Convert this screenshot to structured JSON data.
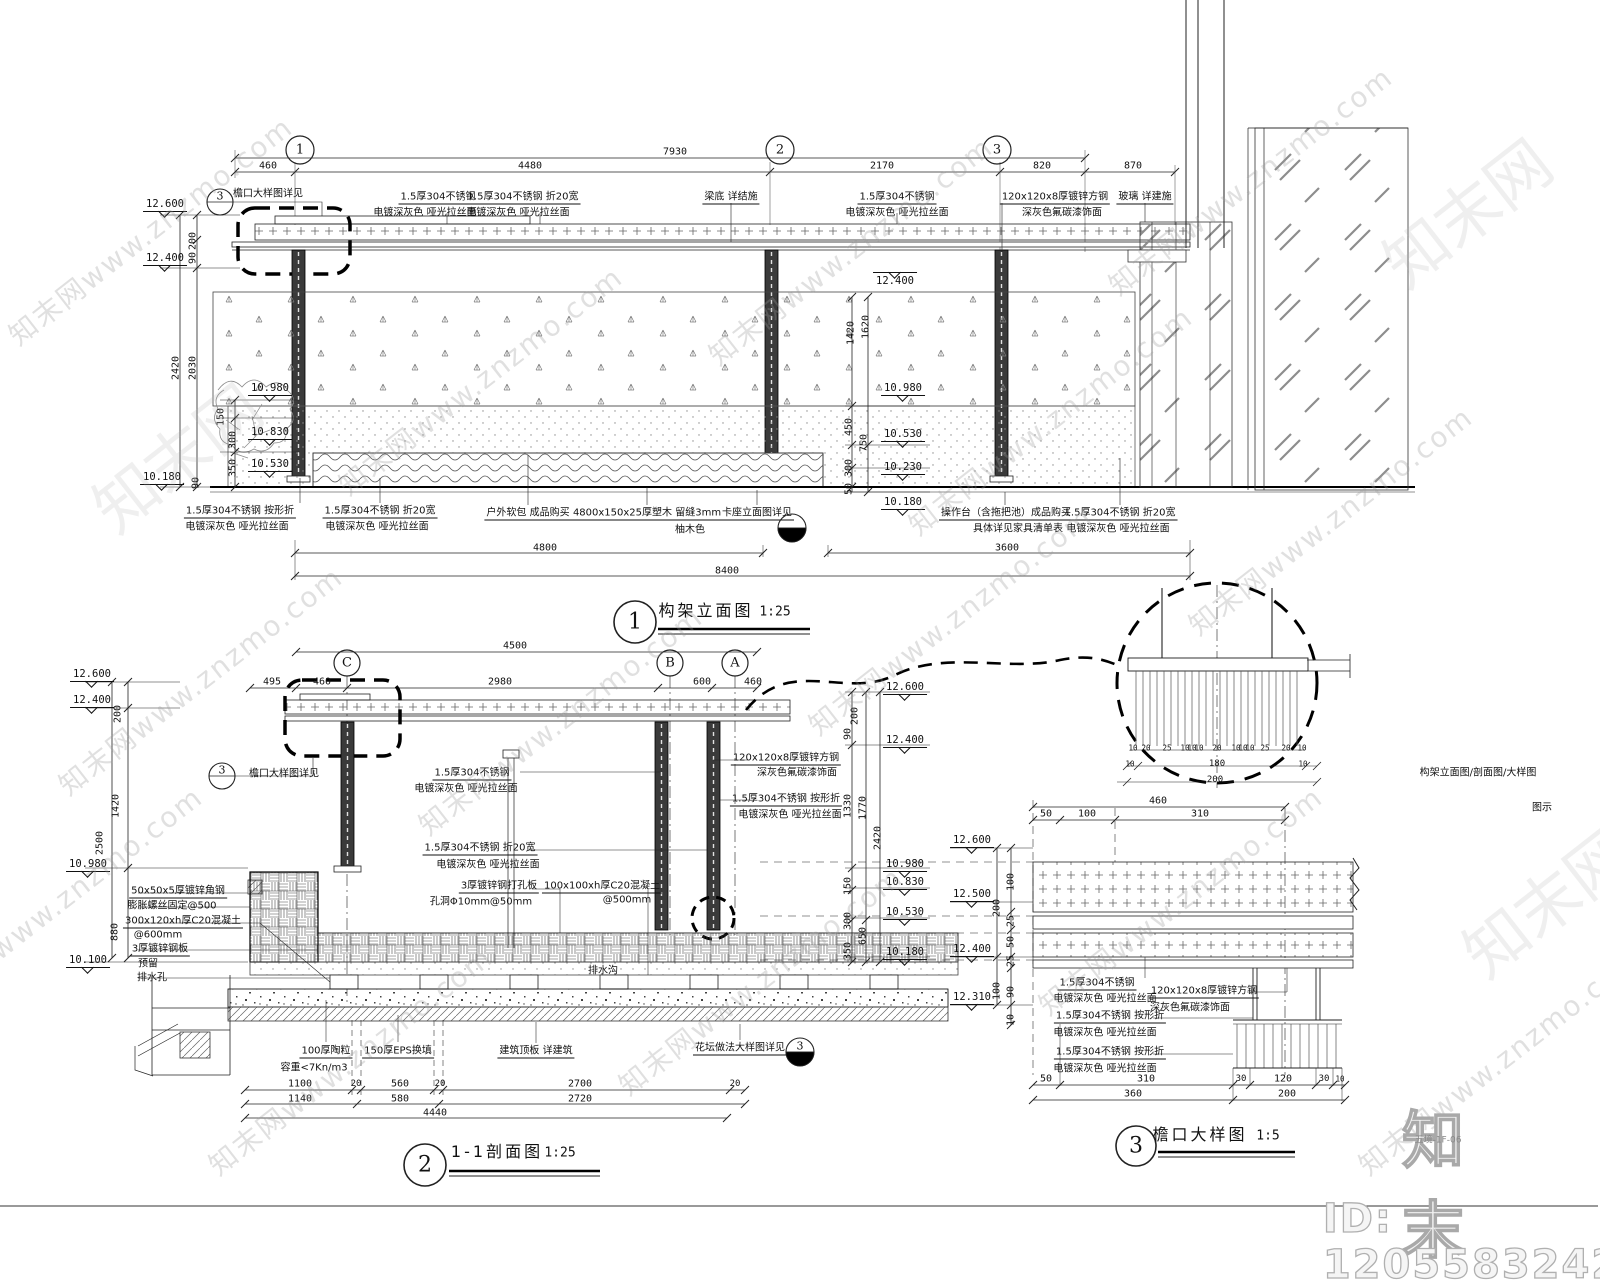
{
  "sheet": {
    "code": "五境-1F-06"
  },
  "watermark": {
    "text": "知末网www.znzmo.com",
    "glyph": "知末网",
    "logo": "知末",
    "id_text": "ID: 1205583242",
    "positions": [
      [
        150,
        230
      ],
      [
        480,
        380
      ],
      [
        850,
        250
      ],
      [
        1250,
        180
      ],
      [
        200,
        680
      ],
      [
        560,
        720
      ],
      [
        950,
        620
      ],
      [
        1330,
        520
      ],
      [
        350,
        1060
      ],
      [
        760,
        980
      ],
      [
        1180,
        900
      ],
      [
        1500,
        1060
      ],
      [
        60,
        900
      ],
      [
        1050,
        420
      ]
    ],
    "glyph_positions": [
      [
        1465,
        210
      ],
      [
        175,
        455
      ],
      [
        1545,
        900
      ]
    ]
  },
  "views": [
    {
      "num": "1",
      "name": "构架立面图",
      "scale": "1:25"
    },
    {
      "num": "2",
      "name": "1-1剖面图",
      "scale": "1:25"
    },
    {
      "num": "3",
      "name": "檐口大样图",
      "scale": "1:5"
    }
  ],
  "side_note": "构架立面图/剖面图/大样图",
  "side_note2": "图示",
  "labels": [
    {
      "t": "7930",
      "x": 675,
      "y": 152,
      "c": "dim"
    },
    {
      "t": "460",
      "x": 268,
      "y": 166,
      "c": "dim"
    },
    {
      "t": "4480",
      "x": 530,
      "y": 166,
      "c": "dim"
    },
    {
      "t": "2170",
      "x": 882,
      "y": 166,
      "c": "dim"
    },
    {
      "t": "820",
      "x": 1042,
      "y": 166,
      "c": "dim"
    },
    {
      "t": "870",
      "x": 1133,
      "y": 166,
      "c": "dim"
    },
    {
      "t": "1",
      "x": 300,
      "y": 150,
      "c": "bub"
    },
    {
      "t": "2",
      "x": 780,
      "y": 150,
      "c": "bub"
    },
    {
      "t": "3",
      "x": 997,
      "y": 150,
      "c": "bub"
    },
    {
      "t": "3",
      "x": 220,
      "y": 196,
      "c": "bubs"
    },
    {
      "t": "檐口大样图详见",
      "x": 268,
      "y": 192,
      "c": "ann"
    },
    {
      "t": "1.5厚304不锈钢",
      "x": 438,
      "y": 196,
      "c": "annu"
    },
    {
      "t": "电镀深灰色 哑光拉丝面",
      "x": 425,
      "y": 211,
      "c": "ann"
    },
    {
      "t": "1.5厚304不锈钢 折20宽",
      "x": 523,
      "y": 196,
      "c": "annu"
    },
    {
      "t": "电镀深灰色 哑光拉丝面",
      "x": 518,
      "y": 211,
      "c": "ann"
    },
    {
      "t": "梁底 详结施",
      "x": 731,
      "y": 196,
      "c": "annu"
    },
    {
      "t": "1.5厚304不锈钢",
      "x": 897,
      "y": 196,
      "c": "annu"
    },
    {
      "t": "电镀深灰色 哑光拉丝面",
      "x": 897,
      "y": 211,
      "c": "ann"
    },
    {
      "t": "120x120x8厚镀锌方钢",
      "x": 1055,
      "y": 196,
      "c": "annu"
    },
    {
      "t": "深灰色氟碳漆饰面",
      "x": 1062,
      "y": 211,
      "c": "ann"
    },
    {
      "t": "玻璃 详建施",
      "x": 1145,
      "y": 196,
      "c": "annu"
    },
    {
      "t": "12.400",
      "x": 895,
      "y": 272,
      "c": "elevt"
    },
    {
      "t": "12.600",
      "x": 165,
      "y": 212,
      "c": "elev"
    },
    {
      "t": "12.400",
      "x": 165,
      "y": 266,
      "c": "elev"
    },
    {
      "t": "10.180",
      "x": 162,
      "y": 485,
      "c": "elev"
    },
    {
      "t": "200",
      "x": 193,
      "y": 241,
      "c": "dimv"
    },
    {
      "t": "90",
      "x": 193,
      "y": 258,
      "c": "dimv"
    },
    {
      "t": "2420",
      "x": 176,
      "y": 368,
      "c": "dimv"
    },
    {
      "t": "2030",
      "x": 193,
      "y": 368,
      "c": "dimv"
    },
    {
      "t": "90",
      "x": 196,
      "y": 483,
      "c": "dimv"
    },
    {
      "t": "150",
      "x": 221,
      "y": 417,
      "c": "dimv"
    },
    {
      "t": "300",
      "x": 233,
      "y": 440,
      "c": "dimv"
    },
    {
      "t": "350",
      "x": 233,
      "y": 468,
      "c": "dimv"
    },
    {
      "t": "10.980",
      "x": 270,
      "y": 396,
      "c": "elev"
    },
    {
      "t": "10.830",
      "x": 270,
      "y": 440,
      "c": "elev"
    },
    {
      "t": "10.530",
      "x": 270,
      "y": 472,
      "c": "elev"
    },
    {
      "t": "1420",
      "x": 851,
      "y": 333,
      "c": "dimv"
    },
    {
      "t": "1620",
      "x": 866,
      "y": 327,
      "c": "dimv"
    },
    {
      "t": "450",
      "x": 849,
      "y": 427,
      "c": "dimv"
    },
    {
      "t": "750",
      "x": 864,
      "y": 443,
      "c": "dimv"
    },
    {
      "t": "300",
      "x": 849,
      "y": 468,
      "c": "dimv"
    },
    {
      "t": "50",
      "x": 849,
      "y": 489,
      "c": "dimv"
    },
    {
      "t": "10.980",
      "x": 903,
      "y": 396,
      "c": "elev"
    },
    {
      "t": "10.530",
      "x": 903,
      "y": 442,
      "c": "elev"
    },
    {
      "t": "10.230",
      "x": 903,
      "y": 475,
      "c": "elev"
    },
    {
      "t": "10.180",
      "x": 903,
      "y": 510,
      "c": "elev"
    },
    {
      "t": "1.5厚304不锈钢 按形折",
      "x": 240,
      "y": 510,
      "c": "annu"
    },
    {
      "t": "电镀深灰色 哑光拉丝面",
      "x": 237,
      "y": 525,
      "c": "ann"
    },
    {
      "t": "1.5厚304不锈钢 折20宽",
      "x": 380,
      "y": 510,
      "c": "annu"
    },
    {
      "t": "电镀深灰色 哑光拉丝面",
      "x": 377,
      "y": 525,
      "c": "ann"
    },
    {
      "t": "户外软包 成品购买",
      "x": 528,
      "y": 512,
      "c": "annu"
    },
    {
      "t": "4800x150x25厚塑木 留缝3mm",
      "x": 647,
      "y": 512,
      "c": "annu"
    },
    {
      "t": "柚木色",
      "x": 690,
      "y": 528,
      "c": "ann"
    },
    {
      "t": "卡座立面图详见",
      "x": 757,
      "y": 512,
      "c": "annu"
    },
    {
      "t": "操作台（含拖把池）成品购买",
      "x": 1006,
      "y": 512,
      "c": "annu"
    },
    {
      "t": "具体详见家具清单表",
      "x": 1018,
      "y": 527,
      "c": "ann"
    },
    {
      "t": "1.5厚304不锈钢 折20宽",
      "x": 1120,
      "y": 512,
      "c": "annu"
    },
    {
      "t": "电镀深灰色 哑光拉丝面",
      "x": 1118,
      "y": 527,
      "c": "ann"
    },
    {
      "t": "4800",
      "x": 545,
      "y": 548,
      "c": "dim"
    },
    {
      "t": "3600",
      "x": 1007,
      "y": 548,
      "c": "dim"
    },
    {
      "t": "8400",
      "x": 727,
      "y": 571,
      "c": "dim"
    },
    {
      "t": "1",
      "x": 635,
      "y": 622,
      "c": "tnum"
    },
    {
      "t": "构架立面图",
      "x": 706,
      "y": 609,
      "c": "ttl"
    },
    {
      "t": "1:25",
      "x": 775,
      "y": 612,
      "c": "sc"
    },
    {
      "t": "C",
      "x": 347,
      "y": 663,
      "c": "bub"
    },
    {
      "t": "B",
      "x": 670,
      "y": 663,
      "c": "bub"
    },
    {
      "t": "A",
      "x": 735,
      "y": 663,
      "c": "bub"
    },
    {
      "t": "4500",
      "x": 515,
      "y": 646,
      "c": "dim"
    },
    {
      "t": "495",
      "x": 272,
      "y": 682,
      "c": "dim"
    },
    {
      "t": "460",
      "x": 322,
      "y": 682,
      "c": "dim"
    },
    {
      "t": "2980",
      "x": 500,
      "y": 682,
      "c": "dim"
    },
    {
      "t": "600",
      "x": 702,
      "y": 682,
      "c": "dim"
    },
    {
      "t": "460",
      "x": 753,
      "y": 682,
      "c": "dim"
    },
    {
      "t": "12.600",
      "x": 92,
      "y": 682,
      "c": "elev"
    },
    {
      "t": "12.400",
      "x": 92,
      "y": 708,
      "c": "elev"
    },
    {
      "t": "200",
      "x": 118,
      "y": 714,
      "c": "dimv"
    },
    {
      "t": "1420",
      "x": 116,
      "y": 806,
      "c": "dimv"
    },
    {
      "t": "2500",
      "x": 100,
      "y": 843,
      "c": "dimv"
    },
    {
      "t": "10.980",
      "x": 88,
      "y": 872,
      "c": "elev"
    },
    {
      "t": "880",
      "x": 115,
      "y": 932,
      "c": "dimv"
    },
    {
      "t": "10.100",
      "x": 88,
      "y": 968,
      "c": "elev"
    },
    {
      "t": "3",
      "x": 222,
      "y": 770,
      "c": "bubs"
    },
    {
      "t": "檐口大样图详见",
      "x": 284,
      "y": 772,
      "c": "ann"
    },
    {
      "t": "50x50x5厚镀锌角钢",
      "x": 178,
      "y": 890,
      "c": "annu"
    },
    {
      "t": "膨胀螺丝固定@500",
      "x": 172,
      "y": 904,
      "c": "ann"
    },
    {
      "t": "300x120xh厚C20混凝土",
      "x": 183,
      "y": 920,
      "c": "annu"
    },
    {
      "t": "@600mm",
      "x": 158,
      "y": 935,
      "c": "ann"
    },
    {
      "t": "3厚镀锌钢板",
      "x": 160,
      "y": 948,
      "c": "annu"
    },
    {
      "t": "预留",
      "x": 148,
      "y": 962,
      "c": "ann"
    },
    {
      "t": "排水孔",
      "x": 152,
      "y": 976,
      "c": "ann"
    },
    {
      "t": "1.5厚304不锈钢",
      "x": 472,
      "y": 772,
      "c": "annu"
    },
    {
      "t": "电镀深灰色 哑光拉丝面",
      "x": 466,
      "y": 787,
      "c": "ann"
    },
    {
      "t": "1.5厚304不锈钢 折20宽",
      "x": 480,
      "y": 847,
      "c": "annu"
    },
    {
      "t": "电镀深灰色 哑光拉丝面",
      "x": 488,
      "y": 863,
      "c": "ann"
    },
    {
      "t": "3厚镀锌钢打孔板",
      "x": 499,
      "y": 885,
      "c": "annu"
    },
    {
      "t": "孔洞Φ10mm@50mm",
      "x": 481,
      "y": 900,
      "c": "ann"
    },
    {
      "t": "100x100xh厚C20混凝土",
      "x": 602,
      "y": 885,
      "c": "annu"
    },
    {
      "t": "@500mm",
      "x": 627,
      "y": 900,
      "c": "ann"
    },
    {
      "t": "120x120x8厚镀锌方钢",
      "x": 786,
      "y": 757,
      "c": "annu"
    },
    {
      "t": "深灰色氟碳漆饰面",
      "x": 797,
      "y": 771,
      "c": "ann"
    },
    {
      "t": "1.5厚304不锈钢 按形折",
      "x": 786,
      "y": 798,
      "c": "annu"
    },
    {
      "t": "电镀深灰色 哑光拉丝面",
      "x": 790,
      "y": 813,
      "c": "ann"
    },
    {
      "t": "排水沟",
      "x": 603,
      "y": 969,
      "c": "ann"
    },
    {
      "t": "200",
      "x": 855,
      "y": 716,
      "c": "dimv"
    },
    {
      "t": "90",
      "x": 848,
      "y": 734,
      "c": "dimv"
    },
    {
      "t": "1330",
      "x": 848,
      "y": 806,
      "c": "dimv"
    },
    {
      "t": "1770",
      "x": 863,
      "y": 808,
      "c": "dimv"
    },
    {
      "t": "2420",
      "x": 878,
      "y": 838,
      "c": "dimv"
    },
    {
      "t": "150",
      "x": 848,
      "y": 886,
      "c": "dimv"
    },
    {
      "t": "300",
      "x": 848,
      "y": 921,
      "c": "dimv"
    },
    {
      "t": "650",
      "x": 863,
      "y": 936,
      "c": "dimv"
    },
    {
      "t": "350",
      "x": 848,
      "y": 951,
      "c": "dimv"
    },
    {
      "t": "12.600",
      "x": 905,
      "y": 695,
      "c": "elev"
    },
    {
      "t": "12.400",
      "x": 905,
      "y": 748,
      "c": "elev"
    },
    {
      "t": "10.980",
      "x": 905,
      "y": 872,
      "c": "elev"
    },
    {
      "t": "10.830",
      "x": 905,
      "y": 890,
      "c": "elev"
    },
    {
      "t": "10.530",
      "x": 905,
      "y": 920,
      "c": "elev"
    },
    {
      "t": "10.180",
      "x": 905,
      "y": 960,
      "c": "elev"
    },
    {
      "t": "100厚陶粒",
      "x": 326,
      "y": 1050,
      "c": "annu"
    },
    {
      "t": "容重<7Kn/m3",
      "x": 314,
      "y": 1066,
      "c": "ann"
    },
    {
      "t": "150厚EPS换填",
      "x": 398,
      "y": 1050,
      "c": "annu"
    },
    {
      "t": "建筑顶板 详建筑",
      "x": 536,
      "y": 1050,
      "c": "annu"
    },
    {
      "t": "花坛做法大样图详见",
      "x": 740,
      "y": 1047,
      "c": "annu"
    },
    {
      "t": "3",
      "x": 800,
      "y": 1046,
      "c": "bubs"
    },
    {
      "t": "1100",
      "x": 300,
      "y": 1084,
      "c": "dim"
    },
    {
      "t": "20",
      "x": 356,
      "y": 1084,
      "c": "tiny2"
    },
    {
      "t": "560",
      "x": 400,
      "y": 1084,
      "c": "dim"
    },
    {
      "t": "20",
      "x": 440,
      "y": 1084,
      "c": "tiny2"
    },
    {
      "t": "2700",
      "x": 580,
      "y": 1084,
      "c": "dim"
    },
    {
      "t": "20",
      "x": 735,
      "y": 1084,
      "c": "tiny2"
    },
    {
      "t": "1140",
      "x": 300,
      "y": 1099,
      "c": "dim"
    },
    {
      "t": "580",
      "x": 400,
      "y": 1099,
      "c": "dim"
    },
    {
      "t": "2720",
      "x": 580,
      "y": 1099,
      "c": "dim"
    },
    {
      "t": "4440",
      "x": 435,
      "y": 1113,
      "c": "dim"
    },
    {
      "t": "2",
      "x": 425,
      "y": 1165,
      "c": "tnum"
    },
    {
      "t": "1-1剖面图",
      "x": 497,
      "y": 1150,
      "c": "ttl"
    },
    {
      "t": "1:25",
      "x": 560,
      "y": 1153,
      "c": "sc"
    },
    {
      "t": "10",
      "x": 1133,
      "y": 748,
      "c": "tiny"
    },
    {
      "t": "20",
      "x": 1146,
      "y": 748,
      "c": "tiny"
    },
    {
      "t": "25",
      "x": 1167,
      "y": 748,
      "c": "tiny"
    },
    {
      "t": "10",
      "x": 1185,
      "y": 748,
      "c": "tiny"
    },
    {
      "t": "10",
      "x": 1192,
      "y": 748,
      "c": "tiny"
    },
    {
      "t": "10",
      "x": 1199,
      "y": 748,
      "c": "tiny"
    },
    {
      "t": "20",
      "x": 1217,
      "y": 748,
      "c": "tiny"
    },
    {
      "t": "10",
      "x": 1236,
      "y": 748,
      "c": "tiny"
    },
    {
      "t": "10",
      "x": 1243,
      "y": 748,
      "c": "tiny"
    },
    {
      "t": "10",
      "x": 1250,
      "y": 748,
      "c": "tiny"
    },
    {
      "t": "25",
      "x": 1265,
      "y": 748,
      "c": "tiny"
    },
    {
      "t": "20",
      "x": 1286,
      "y": 748,
      "c": "tiny"
    },
    {
      "t": "10",
      "x": 1302,
      "y": 748,
      "c": "tiny"
    },
    {
      "t": "10",
      "x": 1130,
      "y": 764,
      "c": "tiny"
    },
    {
      "t": "180",
      "x": 1217,
      "y": 764,
      "c": "tiny2"
    },
    {
      "t": "10",
      "x": 1303,
      "y": 764,
      "c": "tiny"
    },
    {
      "t": "200",
      "x": 1215,
      "y": 780,
      "c": "tiny2"
    },
    {
      "t": "460",
      "x": 1158,
      "y": 801,
      "c": "dim"
    },
    {
      "t": "构架立面图/剖面图/大样图",
      "x": 1478,
      "y": 771,
      "c": "ann"
    },
    {
      "t": "图示",
      "x": 1542,
      "y": 806,
      "c": "ann"
    },
    {
      "t": "50",
      "x": 1046,
      "y": 814,
      "c": "dim"
    },
    {
      "t": "100",
      "x": 1087,
      "y": 814,
      "c": "dim"
    },
    {
      "t": "310",
      "x": 1200,
      "y": 814,
      "c": "dim"
    },
    {
      "t": "12.600",
      "x": 972,
      "y": 848,
      "c": "elev"
    },
    {
      "t": "12.500",
      "x": 972,
      "y": 902,
      "c": "elev"
    },
    {
      "t": "12.400",
      "x": 972,
      "y": 957,
      "c": "elev"
    },
    {
      "t": "12.310",
      "x": 972,
      "y": 1005,
      "c": "elev"
    },
    {
      "t": "100",
      "x": 1011,
      "y": 882,
      "c": "dimv"
    },
    {
      "t": "200",
      "x": 997,
      "y": 908,
      "c": "dimv"
    },
    {
      "t": "25",
      "x": 1011,
      "y": 921,
      "c": "dimv"
    },
    {
      "t": "50",
      "x": 1011,
      "y": 942,
      "c": "dimv"
    },
    {
      "t": "25",
      "x": 1011,
      "y": 961,
      "c": "dimv"
    },
    {
      "t": "90",
      "x": 1011,
      "y": 992,
      "c": "dimv"
    },
    {
      "t": "100",
      "x": 997,
      "y": 991,
      "c": "dimv"
    },
    {
      "t": "10",
      "x": 1011,
      "y": 1020,
      "c": "dimv"
    },
    {
      "t": "1.5厚304不锈钢",
      "x": 1097,
      "y": 982,
      "c": "annu"
    },
    {
      "t": "电镀深灰色 哑光拉丝面",
      "x": 1105,
      "y": 997,
      "c": "ann"
    },
    {
      "t": "120x120x8厚镀锌方钢",
      "x": 1204,
      "y": 990,
      "c": "annu"
    },
    {
      "t": "深灰色氟碳漆饰面",
      "x": 1190,
      "y": 1006,
      "c": "ann"
    },
    {
      "t": "1.5厚304不锈钢 按形折",
      "x": 1110,
      "y": 1015,
      "c": "annu"
    },
    {
      "t": "电镀深灰色 哑光拉丝面",
      "x": 1105,
      "y": 1031,
      "c": "ann"
    },
    {
      "t": "1.5厚304不锈钢 按形折",
      "x": 1110,
      "y": 1051,
      "c": "annu"
    },
    {
      "t": "电镀深灰色 哑光拉丝面",
      "x": 1105,
      "y": 1067,
      "c": "ann"
    },
    {
      "t": "50",
      "x": 1046,
      "y": 1079,
      "c": "dim"
    },
    {
      "t": "310",
      "x": 1146,
      "y": 1079,
      "c": "dim"
    },
    {
      "t": "30",
      "x": 1241,
      "y": 1079,
      "c": "tiny2"
    },
    {
      "t": "120",
      "x": 1283,
      "y": 1079,
      "c": "dim"
    },
    {
      "t": "30",
      "x": 1324,
      "y": 1079,
      "c": "tiny2"
    },
    {
      "t": "10",
      "x": 1340,
      "y": 1079,
      "c": "tiny"
    },
    {
      "t": "360",
      "x": 1133,
      "y": 1094,
      "c": "dim"
    },
    {
      "t": "200",
      "x": 1287,
      "y": 1094,
      "c": "dim"
    },
    {
      "t": "3",
      "x": 1136,
      "y": 1146,
      "c": "tnum"
    },
    {
      "t": "檐口大样图",
      "x": 1200,
      "y": 1133,
      "c": "ttl"
    },
    {
      "t": "1:5",
      "x": 1268,
      "y": 1136,
      "c": "sc"
    }
  ]
}
